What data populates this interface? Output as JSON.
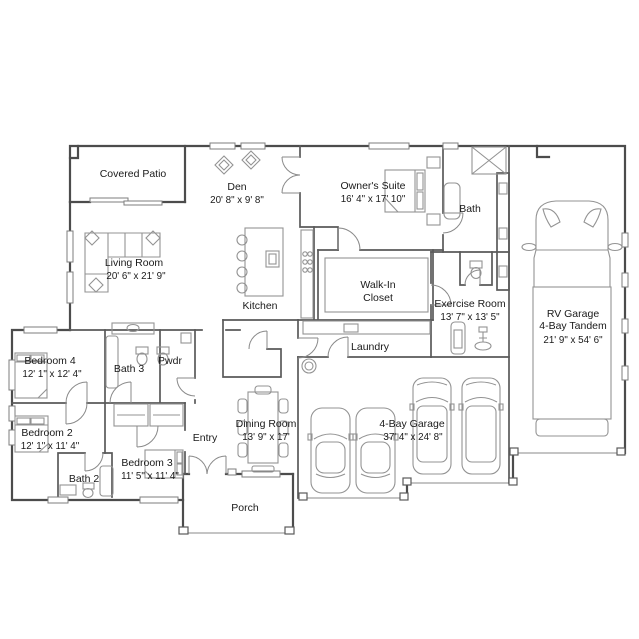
{
  "colors": {
    "background": "#ffffff",
    "walls": "#4c4c4c",
    "thin_lines": "#8a8a8a",
    "text": "#1a1a1a"
  },
  "rooms": {
    "covered_patio": {
      "name": "Covered Patio"
    },
    "den": {
      "name": "Den",
      "dims": "20' 8\" x 9' 8\""
    },
    "owners_suite": {
      "name": "Owner's Suite",
      "dims": "16' 4\" x 17' 10\""
    },
    "bath": {
      "name": "Bath"
    },
    "living_room": {
      "name": "Living Room",
      "dims": "20' 6\" x 21' 9\""
    },
    "kitchen": {
      "name": "Kitchen"
    },
    "walk_in_closet": {
      "line1": "Walk-In",
      "line2": "Closet"
    },
    "exercise_room": {
      "name": "Exercise Room",
      "dims": "13' 7\" x 13' 5\""
    },
    "laundry": {
      "name": "Laundry"
    },
    "rv_garage": {
      "line1": "RV Garage",
      "line2": "4-Bay Tandem",
      "dims": "21' 9\" x 54' 6\""
    },
    "bedroom_4": {
      "name": "Bedroom 4",
      "dims": "12' 1\" x 12' 4\""
    },
    "bath_3": {
      "name": "Bath 3"
    },
    "pwdr": {
      "name": "Pwdr"
    },
    "bedroom_2": {
      "name": "Bedroom 2",
      "dims": "12' 1\" x 11' 4\""
    },
    "bath_2": {
      "name": "Bath 2"
    },
    "bedroom_3": {
      "name": "Bedroom 3",
      "dims": "11' 5\" x 11' 4\""
    },
    "entry": {
      "name": "Entry"
    },
    "dining_room": {
      "name": "Dining Room",
      "dims": "13' 9\" x 17'"
    },
    "four_bay_garage": {
      "name": "4-Bay Garage",
      "dims": "37' 4\" x 24' 8\""
    },
    "porch": {
      "name": "Porch"
    }
  }
}
